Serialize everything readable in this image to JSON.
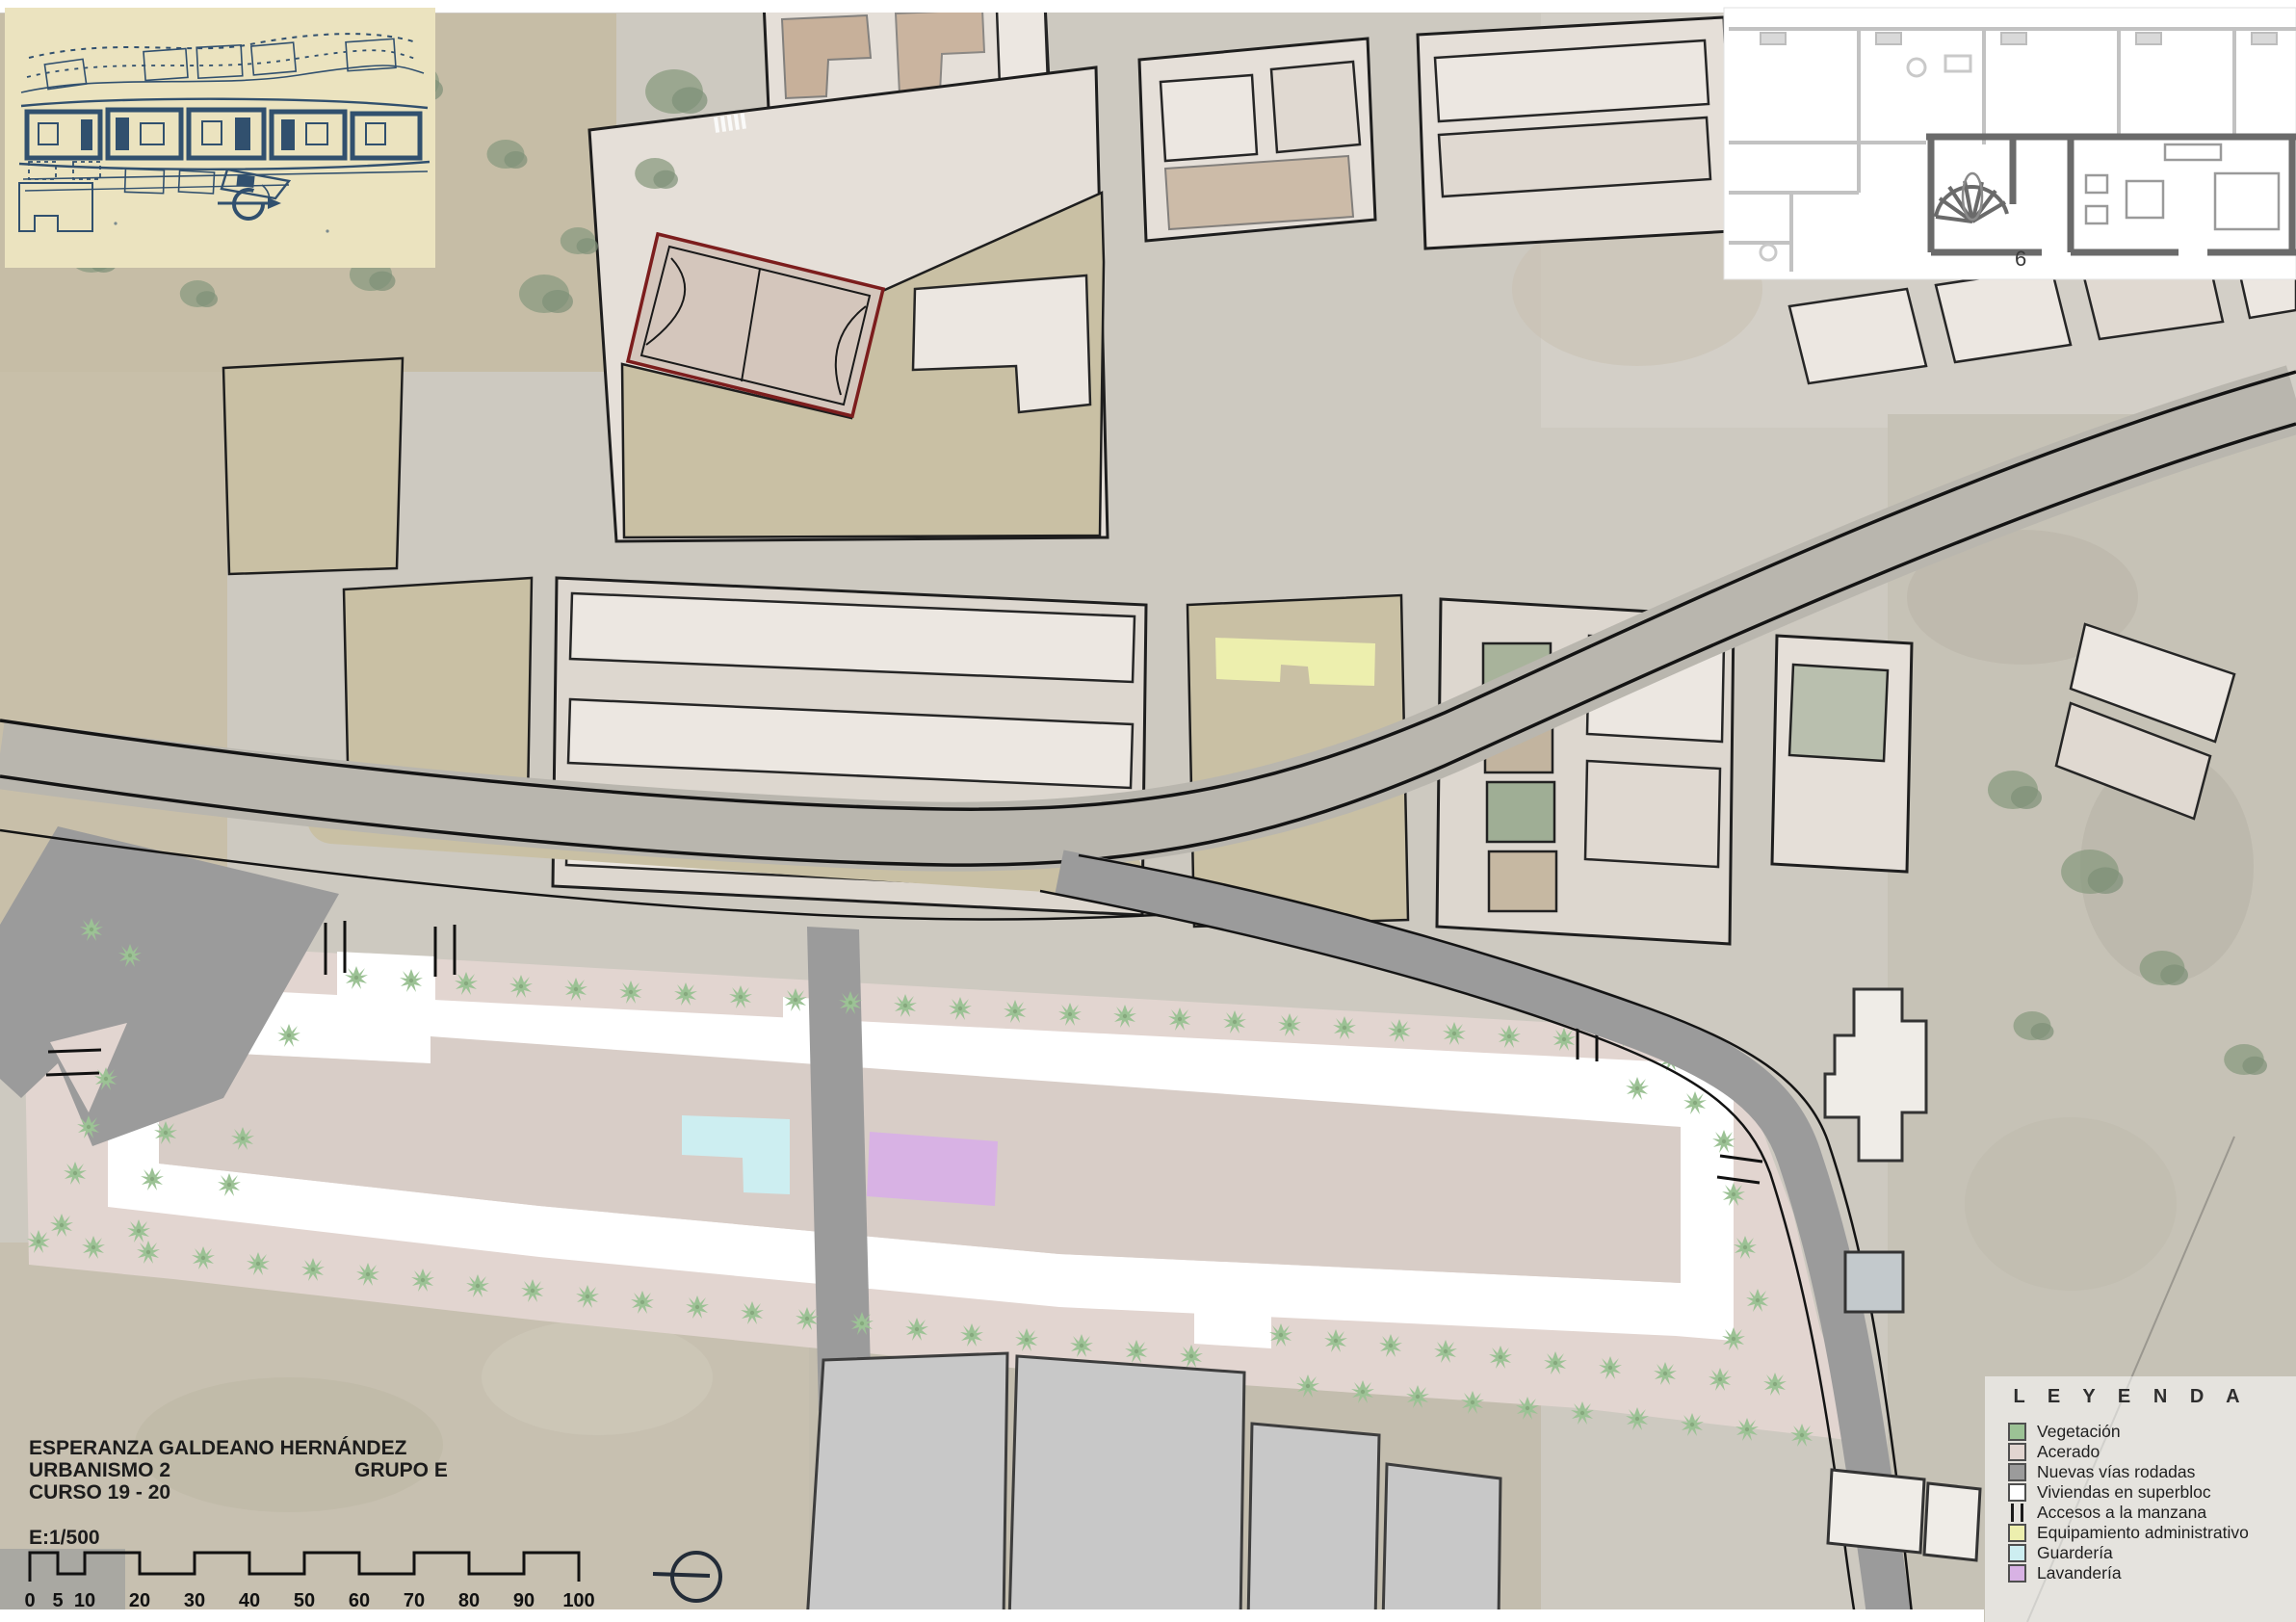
{
  "project": {
    "author": "ESPERANZA GALDEANO HERNÁNDEZ",
    "course": "URBANISMO 2",
    "group": "GRUPO E",
    "year": "CURSO 19 - 20",
    "scale_label": "E:1/500"
  },
  "scale_bar": {
    "ticks": [
      "0",
      "5",
      "10",
      "20",
      "30",
      "40",
      "50",
      "60",
      "70",
      "80",
      "90",
      "100"
    ]
  },
  "legend": {
    "title": "L E Y E N D A",
    "items": [
      {
        "label": "Vegetación",
        "color": "#9cc295",
        "type": "swatch"
      },
      {
        "label": "Acerado",
        "color": "#e2d5d0",
        "type": "swatch"
      },
      {
        "label": "Nuevas vías rodadas",
        "color": "#9b9b9b",
        "type": "swatch"
      },
      {
        "label": "Viviendas en superbloc",
        "color": "#ffffff",
        "type": "swatch"
      },
      {
        "label": "Accesos a la manzana",
        "color": "#1a1a1a",
        "type": "bars"
      },
      {
        "label": "Equipamiento administrativo",
        "color": "#edefae",
        "type": "swatch"
      },
      {
        "label": "Guardería",
        "color": "#cdeef1",
        "type": "swatch"
      },
      {
        "label": "Lavandería",
        "color": "#d8b2e4",
        "type": "swatch"
      }
    ]
  },
  "floorplan_inset": {
    "unit_label": "6"
  },
  "colors": {
    "satellite_base": "#cdc9c0",
    "inner_courtyard": "#d8cdc7",
    "empty_parcel_tan": "#c9c0a4",
    "sports_court_outline": "#7c1d1d",
    "greenhouse_gray": "#c8c8c8",
    "sketch_paper": "#ebe3bf",
    "sketch_ink": "#31506e",
    "road_casing": "#141414"
  }
}
